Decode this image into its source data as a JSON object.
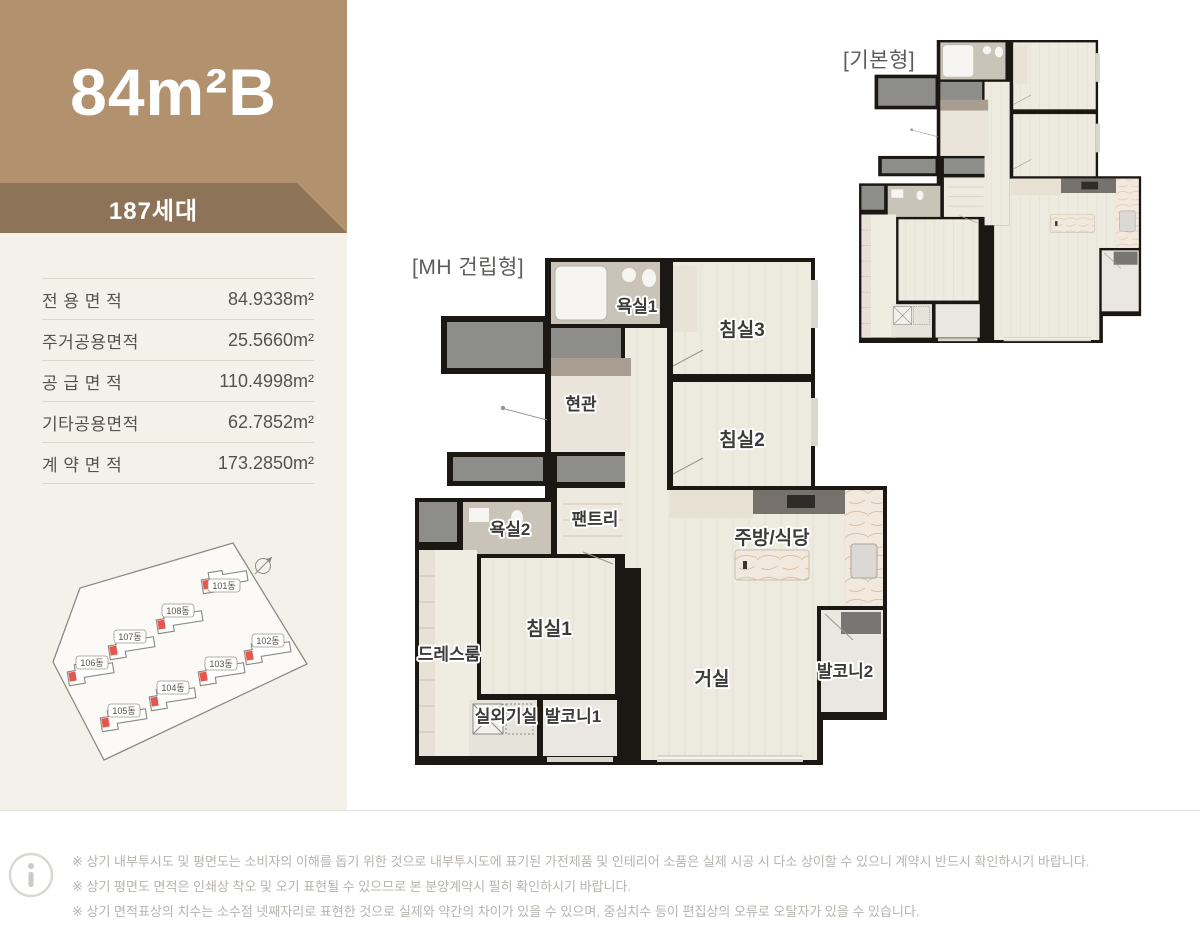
{
  "sidebar": {
    "title": "84m²B",
    "units_badge": "187세대",
    "area_table": [
      {
        "label": "전 용 면 적",
        "value": "84.9338m²"
      },
      {
        "label": "주거공용면적",
        "value": "25.5660m²"
      },
      {
        "label": "공 급 면 적",
        "value": "110.4998m²"
      },
      {
        "label": "기타공용면적",
        "value": "62.7852m²"
      },
      {
        "label": "계 약 면 적",
        "value": "173.2850m²"
      }
    ],
    "site_plan": {
      "buildings": [
        "101동",
        "108동",
        "107동",
        "106동",
        "102동",
        "103동",
        "104동",
        "105동"
      ],
      "marker_color": "#e4574f"
    },
    "colors": {
      "header_bg": "#b2926e",
      "ribbon_bg": "#8d7459",
      "sidebar_bg": "#f4f1ea"
    }
  },
  "plans": {
    "mh": {
      "tag": "[MH 건립형]",
      "rooms": [
        "욕실1",
        "침실3",
        "현관",
        "침실2",
        "팬트리",
        "욕실2",
        "주방/식당",
        "드레스룸",
        "침실1",
        "거실",
        "발코니2",
        "실외기실",
        "발코니1"
      ]
    },
    "basic": {
      "tag": "[기본형]"
    }
  },
  "footer": {
    "notes": [
      "※ 상기 내부투시도 및 평면도는 소비자의 이해를 돕기 위한 것으로 내부투시도에 표기된 가전제품 및 인테리어 소품은 실제 시공 시 다소 상이할 수 있으니 계약시 반드시 확인하시기 바랍니다.",
      "※ 상기 평면도 면적은 인쇄상 착오 및 오기 표현될 수 있으므로 본 분양계약시 필히 확인하시기 바랍니다.",
      "※ 상기 면적표상의 치수는 소수점 넷째자리로 표현한 것으로 실제와 약간의 차이가 있을 수 있으며, 중심치수 등이 편집상의 오류로 오탈자가 있을 수 있습니다."
    ]
  }
}
